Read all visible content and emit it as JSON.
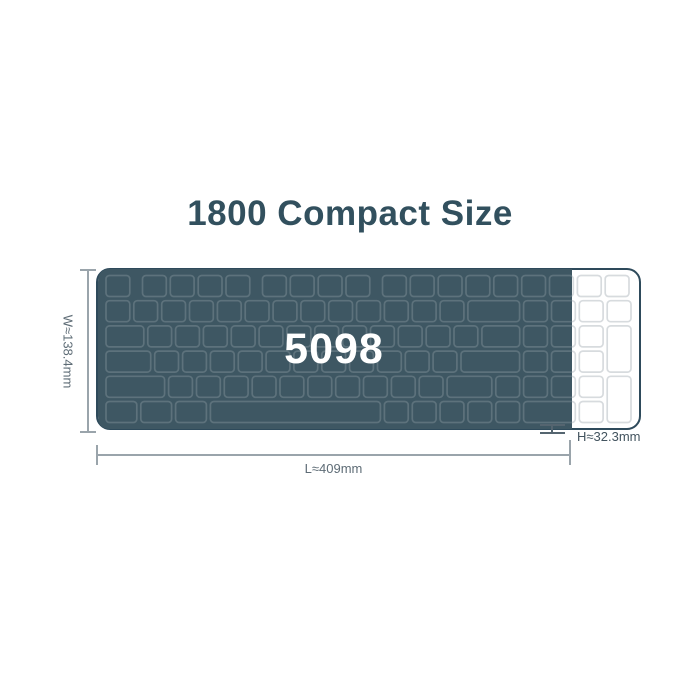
{
  "title": {
    "text": "1800 Compact Size",
    "color": "#32505e"
  },
  "keyboard": {
    "model": "5098",
    "body_fill": "#ffffff",
    "body_stroke": "#2e4a5b",
    "key_stroke_light": "#d7dbde",
    "overlay_fill": "#3e5763",
    "overlay_key_stroke": "rgba(255,255,255,0.16)",
    "model_color": "#ffffff"
  },
  "dimensions": {
    "width_label": "W≈138.4mm",
    "length_label": "L≈409mm",
    "height_label": "H≈32.3mm",
    "line_color": "#9aa4ab",
    "label_color": "#5e6c76",
    "height_label_color": "#43545f",
    "height_mark_color": "#556570"
  }
}
